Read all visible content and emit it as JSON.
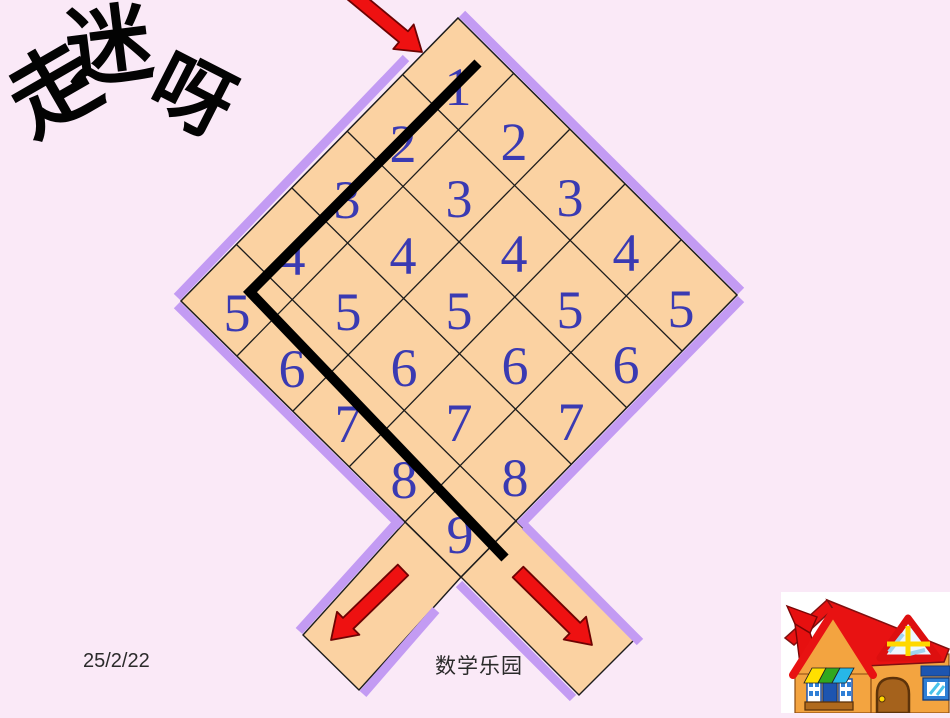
{
  "slide": {
    "background_color": "#fae9f7",
    "title": {
      "full_text": "走迷呀",
      "char1": "走",
      "char2": "迷",
      "char3": "呀"
    },
    "date_text": "25/2/22",
    "footer_text": "数学乐园"
  },
  "maze": {
    "fill_color": "#fbd2a2",
    "border_color": "#c39bf3",
    "outline_color": "#1c1c1c",
    "number_color": "#3a3ab2",
    "solution_path_color": "#000000",
    "arrow_color": "#ee1111",
    "icons": {
      "entry_arrow": "red-arrow-down-right",
      "exit_arrow_left": "red-arrow-down-left",
      "exit_arrow_right": "red-arrow-down-right"
    },
    "cells": [
      {
        "label": "1"
      },
      {
        "label": "2"
      },
      {
        "label": "3"
      },
      {
        "label": "4"
      },
      {
        "label": "5"
      },
      {
        "label": "2"
      },
      {
        "label": "3"
      },
      {
        "label": "4"
      },
      {
        "label": "5"
      },
      {
        "label": "6"
      },
      {
        "label": "3"
      },
      {
        "label": "4"
      },
      {
        "label": "5"
      },
      {
        "label": "6"
      },
      {
        "label": "7"
      },
      {
        "label": "4"
      },
      {
        "label": "5"
      },
      {
        "label": "6"
      },
      {
        "label": "7"
      },
      {
        "label": "8"
      },
      {
        "label": "5"
      },
      {
        "label": "6"
      },
      {
        "label": "7"
      },
      {
        "label": "8"
      },
      {
        "label": "9"
      }
    ]
  }
}
